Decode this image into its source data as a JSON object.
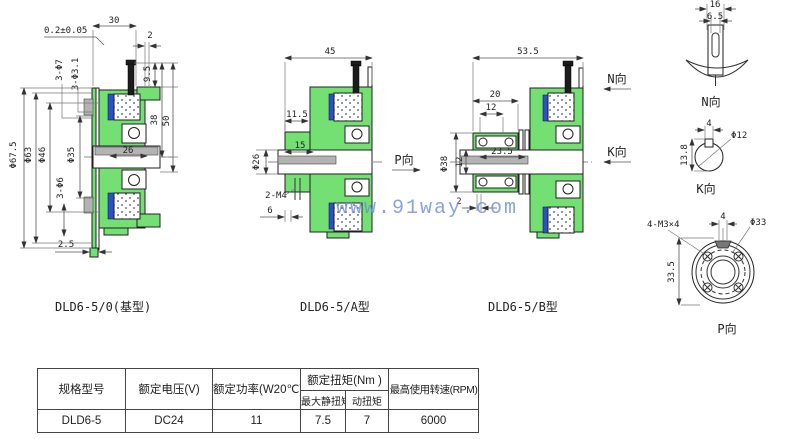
{
  "watermark": "www.91way.com",
  "drawings": {
    "base": {
      "caption": "DLD6-5/0(基型)",
      "dim_30": "30",
      "dim_tol": "0.2±0.05",
      "dim_2": "2",
      "dim_3phi7": "3-Φ7",
      "dim_3phi31": "3-Φ3.1",
      "dim_phi675": "Φ67.5",
      "dim_phi63": "Φ63",
      "dim_phi46": "Φ46",
      "dim_phi35": "Φ35",
      "dim_3phi6": "3-Φ6",
      "dim_26": "26",
      "dim_25": "2.5",
      "dim_95": "9.5",
      "dim_38": "38",
      "dim_50": "50"
    },
    "typeA": {
      "caption": "DLD6-5/A型",
      "dim_45": "45",
      "dim_115": "11.5",
      "dim_phi26": "Φ26",
      "dim_15": "15",
      "dim_2m4": "2-M4",
      "dim_6": "6",
      "view_p": "P向"
    },
    "typeB": {
      "caption": "DLD6-5/B型",
      "dim_535": "53.5",
      "dim_20": "20",
      "dim_12": "12",
      "dim_phi38": "Φ38",
      "dim_12v": "12",
      "dim_235": "23.5",
      "dim_2": "2",
      "view_n": "N向",
      "view_k": "K向"
    },
    "detailN": {
      "caption": "N向",
      "dim_16": "16",
      "dim_65": "6.5"
    },
    "detailK": {
      "caption": "K向",
      "dim_4": "4",
      "dim_phi12": "Φ12",
      "dim_138": "13.8"
    },
    "detailP": {
      "caption": "P向",
      "dim_4": "4",
      "dim_phi33": "Φ33",
      "dim_4m3": "4-M3×4",
      "dim_335": "33.5"
    }
  },
  "table": {
    "col_model": "规格型号",
    "col_voltage": "额定电压(V)",
    "col_power": "额定功率(W20℃)",
    "col_torque": "额定扭矩(Nm )",
    "col_static": "最大静扭矩",
    "col_dynamic": "动扭矩",
    "col_speed": "最高使用转速(RPM)",
    "row": {
      "model": "DLD6-5",
      "voltage": "DC24",
      "power": "11",
      "static": "7.5",
      "dynamic": "7",
      "speed": "6000"
    }
  }
}
